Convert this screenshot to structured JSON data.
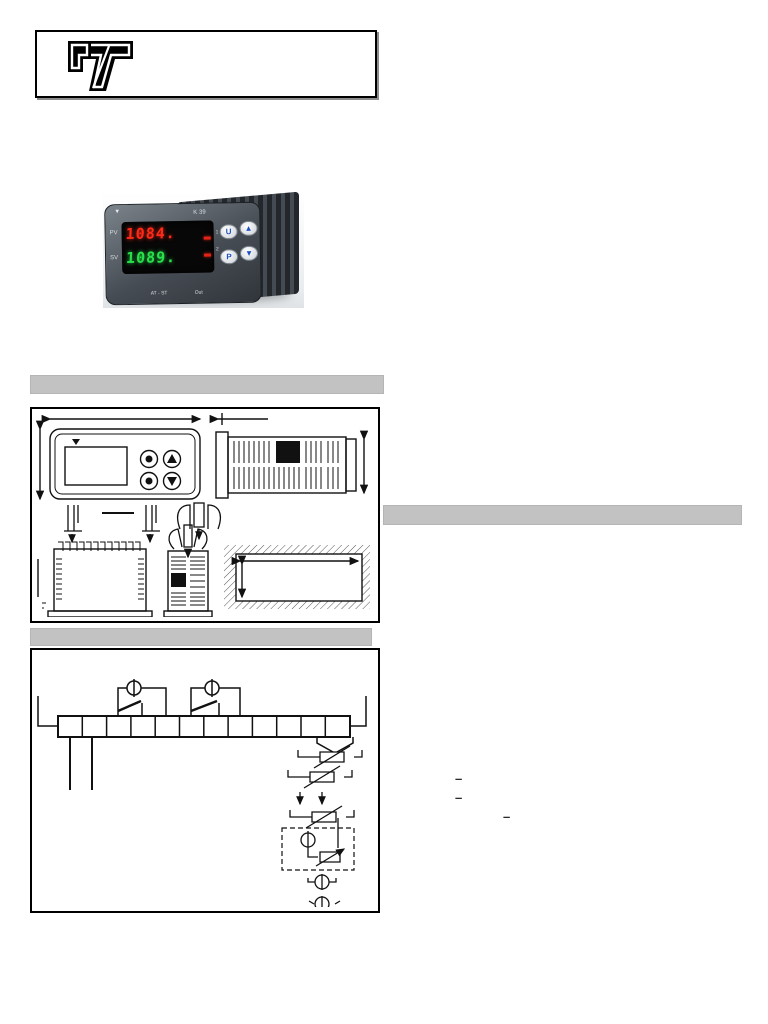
{
  "header_logo_box": {
    "logo_icon": "tecnologic-t-logo"
  },
  "product_photo": {
    "model_label": "K 39",
    "pv_label": "PV",
    "sv_label": "SV",
    "pv_value": "1084.",
    "sv_value": "1089.",
    "out1_indicator_label": "1",
    "out2_indicator_label": "2",
    "button_u_label": "U",
    "button_p_label": "P",
    "button_up_label": "▲",
    "button_down_label": "▼",
    "footer_left_label": "AT - ST",
    "footer_right_label": "Out",
    "colors": {
      "pv_display": "#ff2a18",
      "sv_display": "#27e04a",
      "case": "#4b5157",
      "button_glyph": "#1d4fc0",
      "indicator": "#e02418"
    }
  },
  "section_bars": {
    "color": "#c2c2c2"
  },
  "margin_annotations": {
    "dash_1": "–",
    "dash_2": "–",
    "dash_3": "–"
  }
}
